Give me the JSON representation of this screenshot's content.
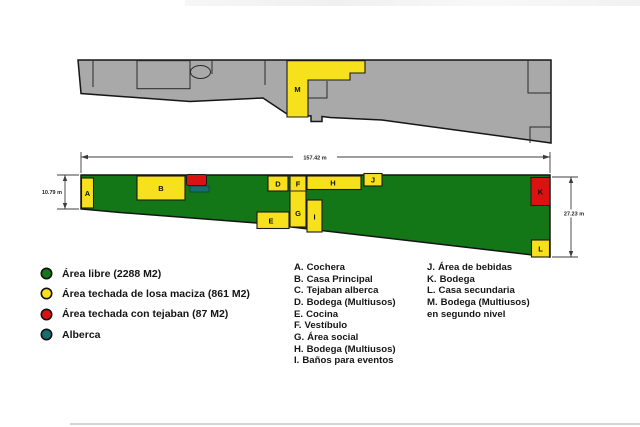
{
  "colors": {
    "free_area_green": "#137718",
    "slab_roof_yellow": "#f7e11c",
    "tejaban_red": "#dc1212",
    "pool_teal": "#1c6b6e",
    "upper_plan_gray": "#a9a9a9"
  },
  "dimensions": {
    "total_width": "157.42 m",
    "left_height": "10.79 m",
    "right_height": "27.23 m"
  },
  "upper_plan": {
    "block_label_m": "M"
  },
  "site_plan": {
    "block_labels": {
      "a": "A",
      "b": "B",
      "d": "D",
      "e": "E",
      "f": "F",
      "g": "G",
      "h": "H",
      "i": "I",
      "j": "J",
      "k": "K",
      "l": "L"
    }
  },
  "legend": {
    "items": [
      {
        "color": "#137718",
        "label": "Área libre (2288 M2)"
      },
      {
        "color": "#f7e11c",
        "label": "Área techada de losa maciza (861 M2)"
      },
      {
        "color": "#dc1212",
        "label": "Área techada con tejaban (87 M2)"
      },
      {
        "color": "#1c6b6e",
        "label": "Alberca"
      }
    ]
  },
  "key_list": {
    "col1": [
      {
        "letter": "A.",
        "name": "Cochera"
      },
      {
        "letter": "B.",
        "name": "Casa Principal"
      },
      {
        "letter": "C.",
        "name": "Tejaban alberca"
      },
      {
        "letter": "D.",
        "name": "Bodega (Multiusos)"
      },
      {
        "letter": "E.",
        "name": "Cocina"
      },
      {
        "letter": "F.",
        "name": "Vestíbulo"
      },
      {
        "letter": "G.",
        "name": "Área social"
      },
      {
        "letter": "H.",
        "name": "Bodega (Multiusos)"
      },
      {
        "letter": "I.",
        "name": "Baños para eventos"
      }
    ],
    "col2": [
      {
        "letter": "J.",
        "name": "Área de bebidas"
      },
      {
        "letter": "K.",
        "name": "Bodega"
      },
      {
        "letter": "L.",
        "name": "Casa secundaria"
      },
      {
        "letter": "M.",
        "name": "Bodega (Multiusos)"
      }
    ],
    "col2_continuation": "en segundo nivel"
  }
}
